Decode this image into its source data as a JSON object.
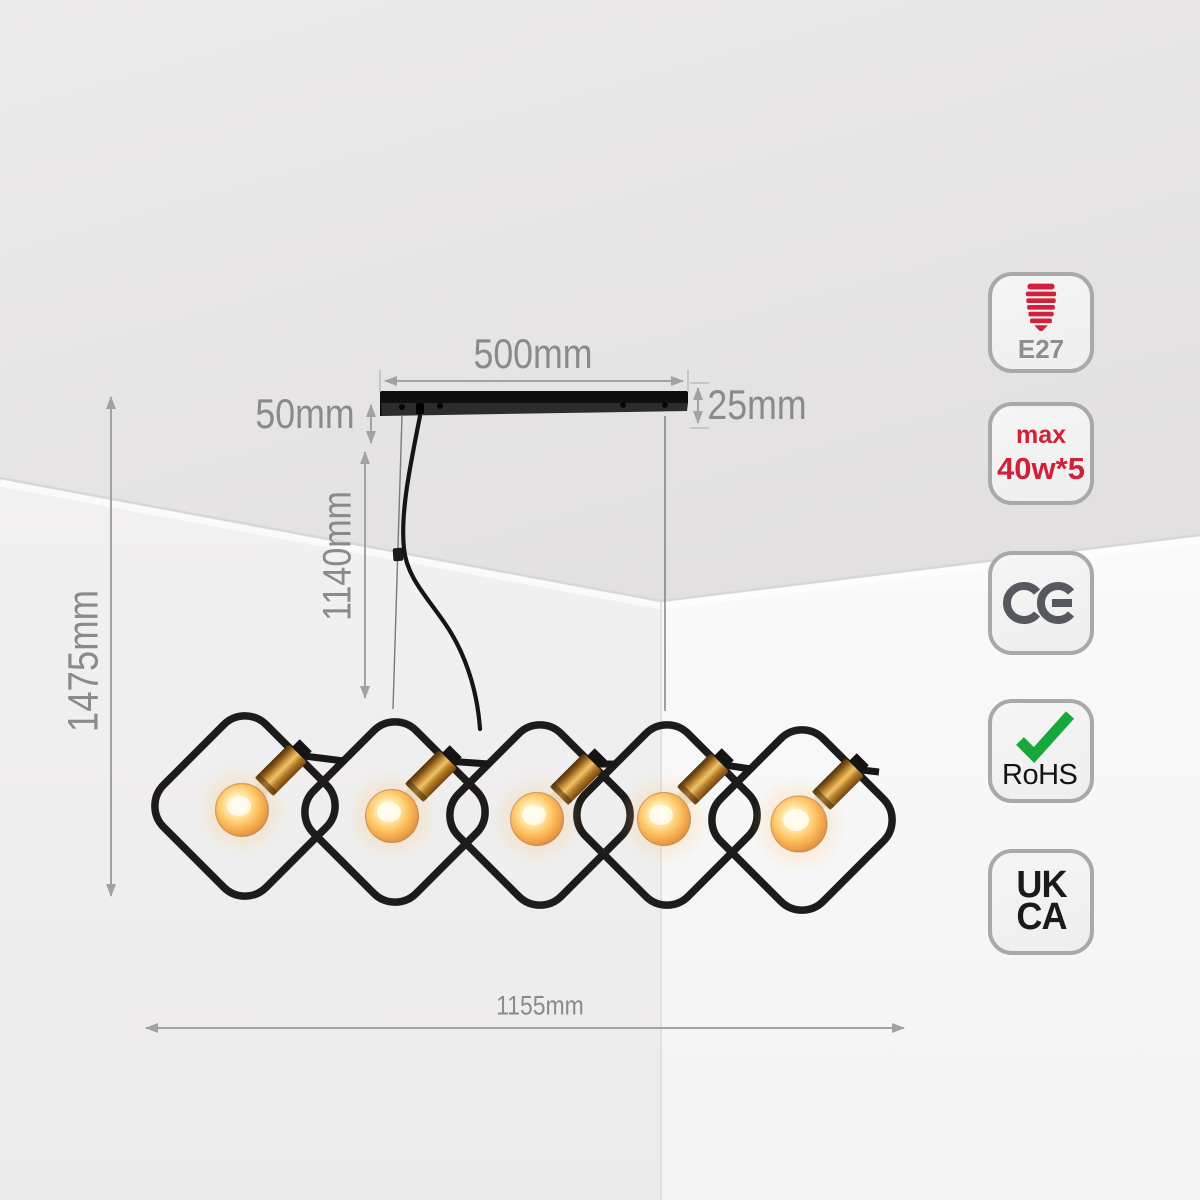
{
  "scene": {
    "description": "Five-light pendant chandelier with rounded-square diamond frames, brass E27 sockets and glowing bulbs, hung by wires and a cord from a black ceiling bar in a room corner"
  },
  "dimension_labels": {
    "bar_length": "500mm",
    "bar_height": "25mm",
    "suspension_offset": "50mm",
    "drop_height": "1140mm",
    "overall_height": "1475mm",
    "overall_width": "1155mm"
  },
  "certification_badges": [
    {
      "id": "e27",
      "icon": "e27-bulb-socket-icon",
      "label": "E27"
    },
    {
      "id": "max-power",
      "line1": "max",
      "line2": "40w*5"
    },
    {
      "id": "ce",
      "icon": "ce-mark-icon",
      "label": "CE"
    },
    {
      "id": "rohs",
      "icon": "green-check-icon",
      "label": "RoHS"
    },
    {
      "id": "ukca",
      "line1": "UK",
      "line2": "CA"
    }
  ],
  "fixture": {
    "bulb_count": 5
  },
  "colors": {
    "badge_red": "#d22038",
    "check_green": "#17a83b",
    "ce_gray": "#55585c",
    "label_gray": "#8a8a8a",
    "badge_border_gray": "#a9a9a9",
    "frame_black": "#1e1c1a",
    "brass": "#cf9a3e",
    "bulb_glow": "#ffc566"
  }
}
